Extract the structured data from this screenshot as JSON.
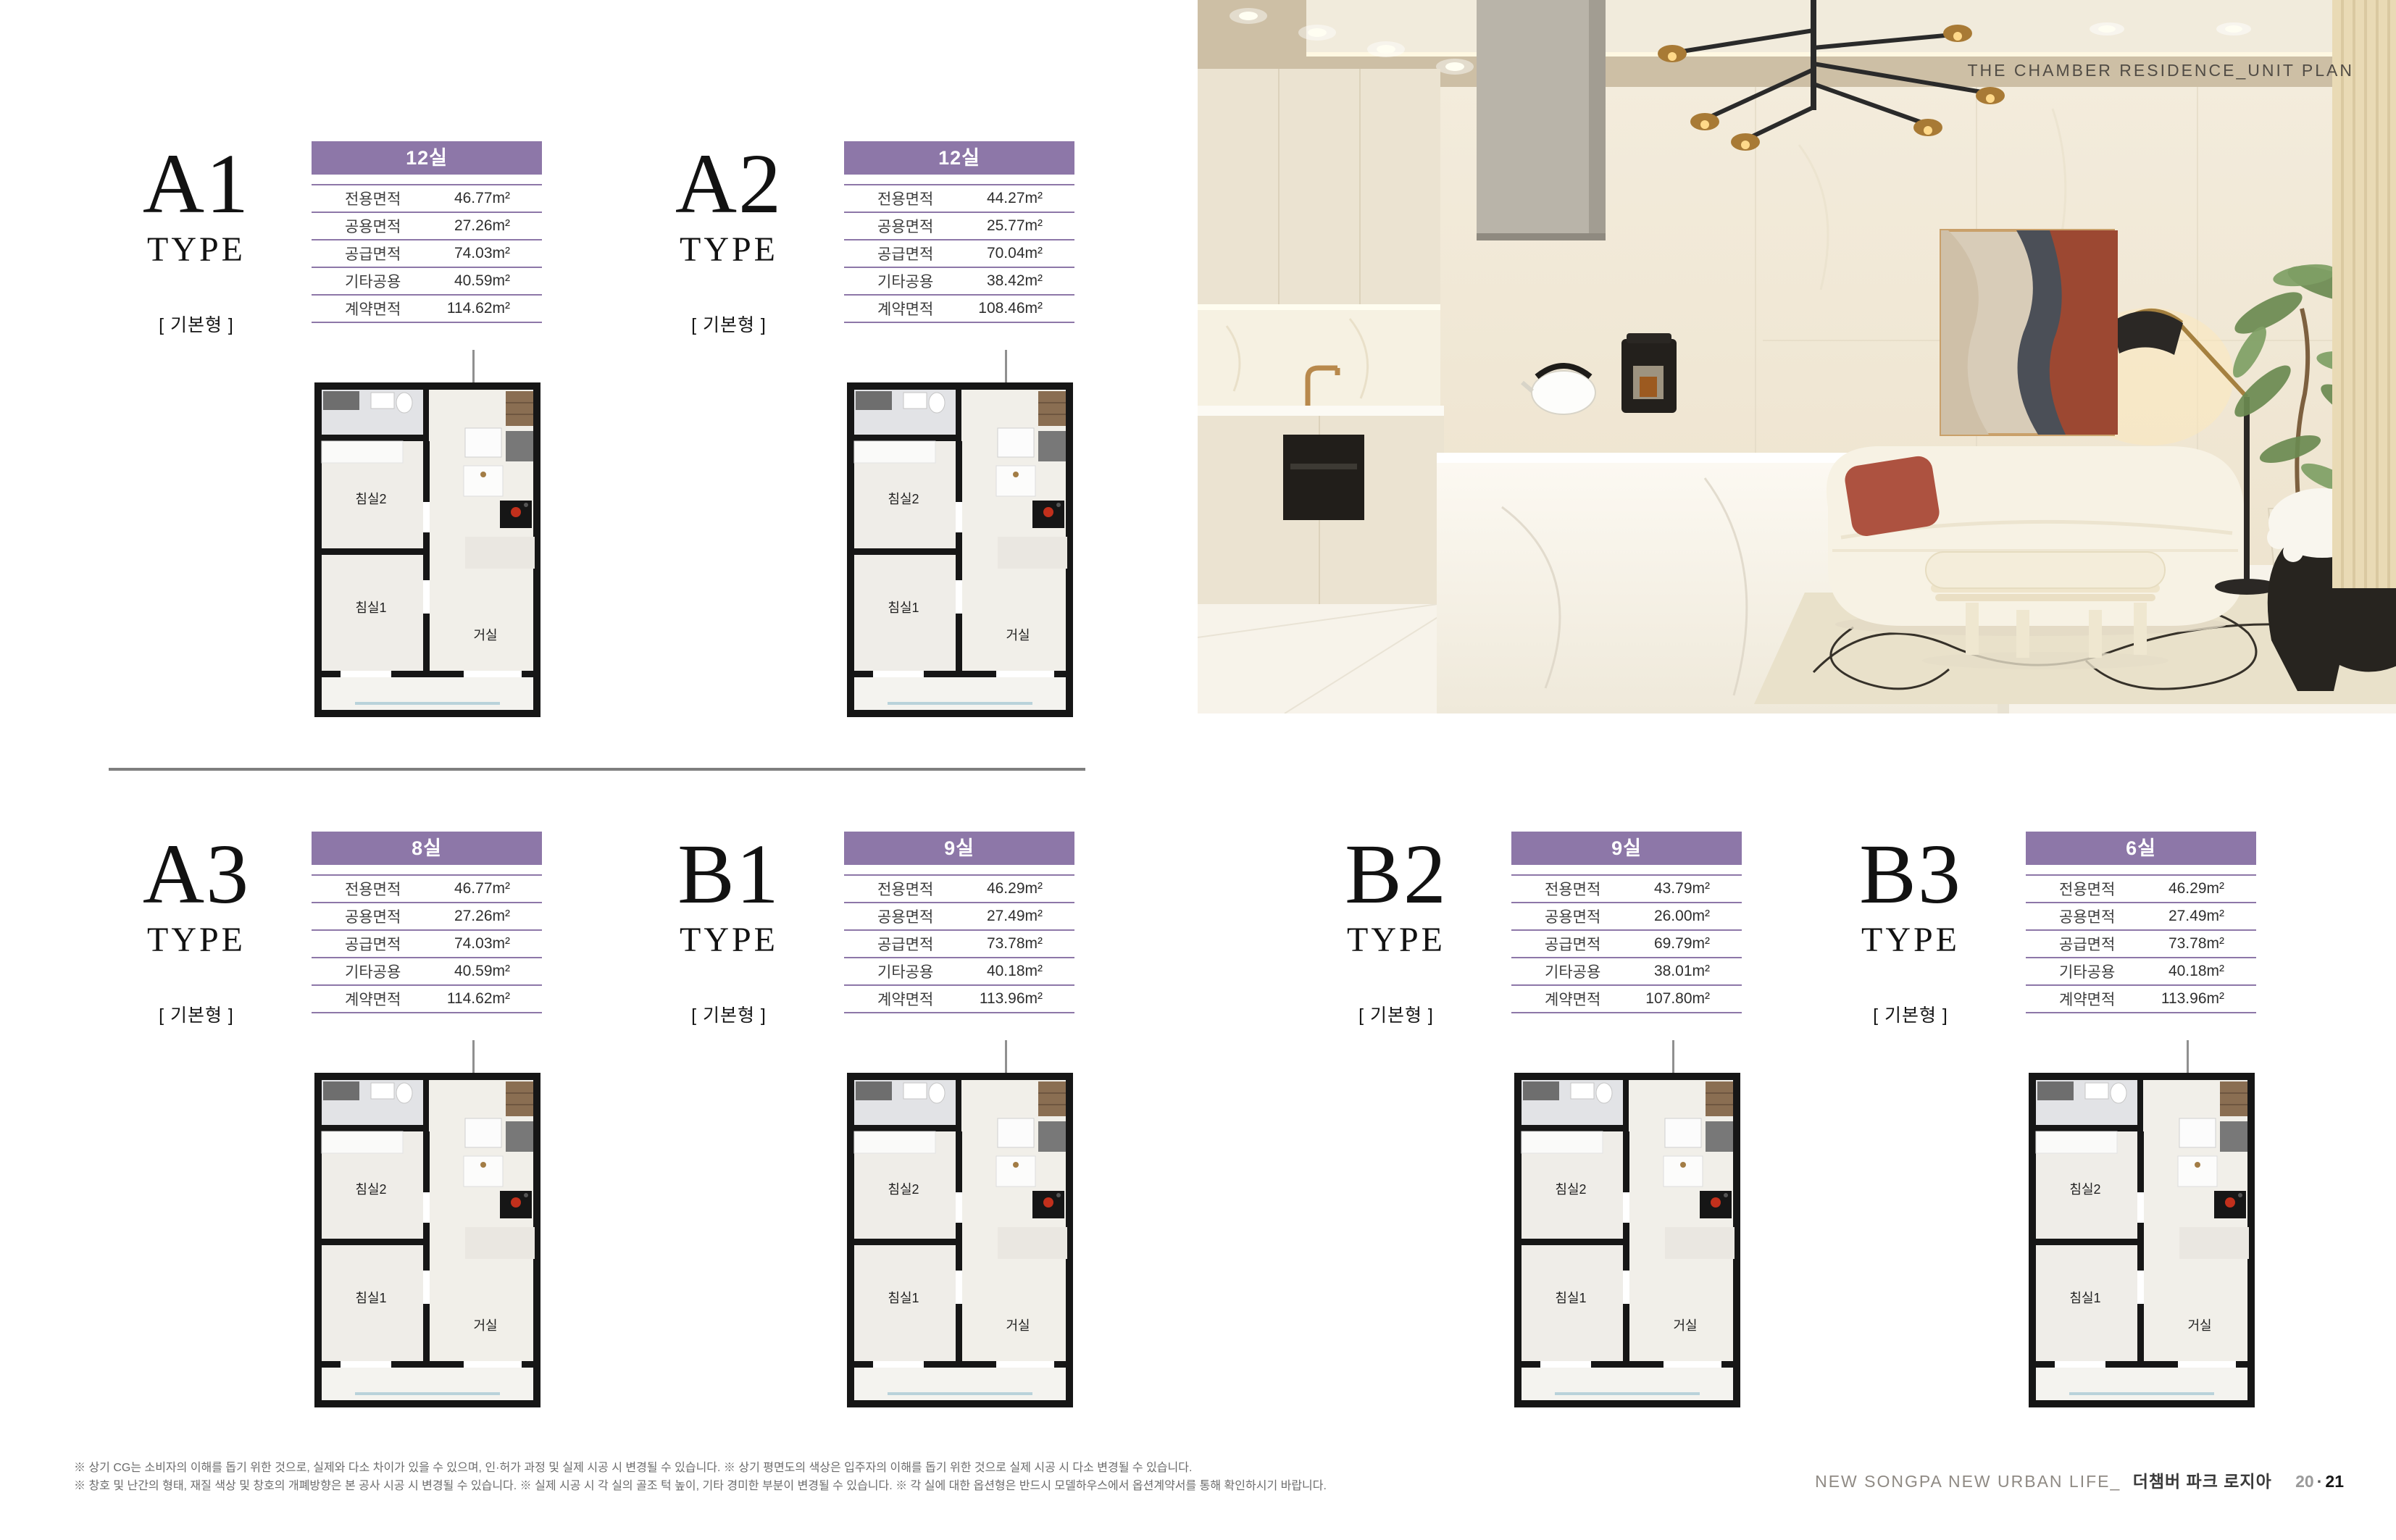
{
  "photo": {
    "caption": "THE CHAMBER RESIDENCE_UNIT PLAN"
  },
  "labels": {
    "type_suffix": "TYPE",
    "variant": "[ 기본형 ]",
    "row_labels": [
      "전용면적",
      "공용면적",
      "공급면적",
      "기타공용",
      "계약면적"
    ],
    "rooms": {
      "bedroom2": "침실2",
      "bedroom1": "침실1",
      "living": "거실"
    }
  },
  "units": [
    {
      "id": "A1",
      "rooms": "12실",
      "values": [
        "46.77m²",
        "27.26m²",
        "74.03m²",
        "40.59m²",
        "114.62m²"
      ]
    },
    {
      "id": "A2",
      "rooms": "12실",
      "values": [
        "44.27m²",
        "25.77m²",
        "70.04m²",
        "38.42m²",
        "108.46m²"
      ]
    },
    {
      "id": "A3",
      "rooms": "8실",
      "values": [
        "46.77m²",
        "27.26m²",
        "74.03m²",
        "40.59m²",
        "114.62m²"
      ]
    },
    {
      "id": "B1",
      "rooms": "9실",
      "values": [
        "46.29m²",
        "27.49m²",
        "73.78m²",
        "40.18m²",
        "113.96m²"
      ]
    },
    {
      "id": "B2",
      "rooms": "9실",
      "values": [
        "43.79m²",
        "26.00m²",
        "69.79m²",
        "38.01m²",
        "107.80m²"
      ]
    },
    {
      "id": "B3",
      "rooms": "6실",
      "values": [
        "46.29m²",
        "27.49m²",
        "73.78m²",
        "40.18m²",
        "113.96m²"
      ]
    }
  ],
  "footer": {
    "disclaimer_line1": "※ 상기 CG는 소비자의 이해를 돕기 위한 것으로, 실제와 다소 차이가 있을 수 있으며, 인·허가 과정 및 실제 시공 시 변경될 수 있습니다.   ※ 상기 평면도의 색상은 입주자의 이해를 돕기 위한 것으로 실제 시공 시 다소 변경될 수 있습니다.",
    "disclaimer_line2": "※ 창호 및 난간의 형태, 재질 색상 및 창호의 개폐방향은 본 공사 시공 시 변경될 수 있습니다.   ※ 실제 시공 시 각 실의 골조 턱 높이, 기타 경미한 부분이 변경될 수 있습니다.   ※ 각 실에 대한 옵션형은 반드시 모델하우스에서 옵션계약서를 통해 확인하시기 바랍니다.",
    "brand": "NEW SONGPA NEW URBAN LIFE_",
    "project": "더챔버 파크 로지아",
    "page_left": "20",
    "page_sep": "·",
    "page_right": "21"
  },
  "colors": {
    "accent_purple": "#8d77a8",
    "divider_gray": "#7f7f7f",
    "title_black": "#121212",
    "photo_caption_color": "#514c45"
  }
}
